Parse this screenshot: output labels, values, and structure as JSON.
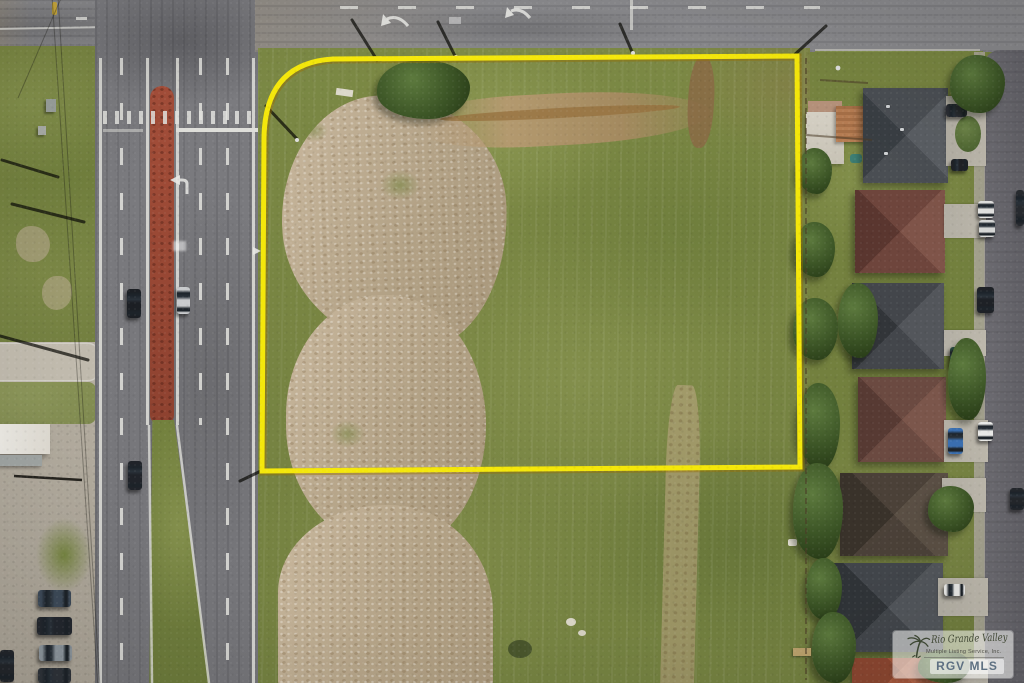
{
  "scene": {
    "kind": "aerial-drone-photo",
    "subject": "Vacant corner land parcel outlined in yellow at a divided-highway intersection beside a residential subdivision"
  },
  "watermark": {
    "logo": "palm-tree-icon",
    "name_script": "Rio Grande Valley",
    "subtitle": "Multiple Listing Service, Inc.",
    "abbreviation": "RGV MLS"
  },
  "annotations": {
    "parcel_boundary_color": "#f4e70b"
  },
  "palette": {
    "field_green": "#7a8745",
    "dirt_tan": "#b9a88d",
    "highway_gray": "#7a7a7e",
    "median_red": "#9d4a37",
    "cross_street_gray": "#88888b",
    "residential_street_gray": "#67666c"
  }
}
